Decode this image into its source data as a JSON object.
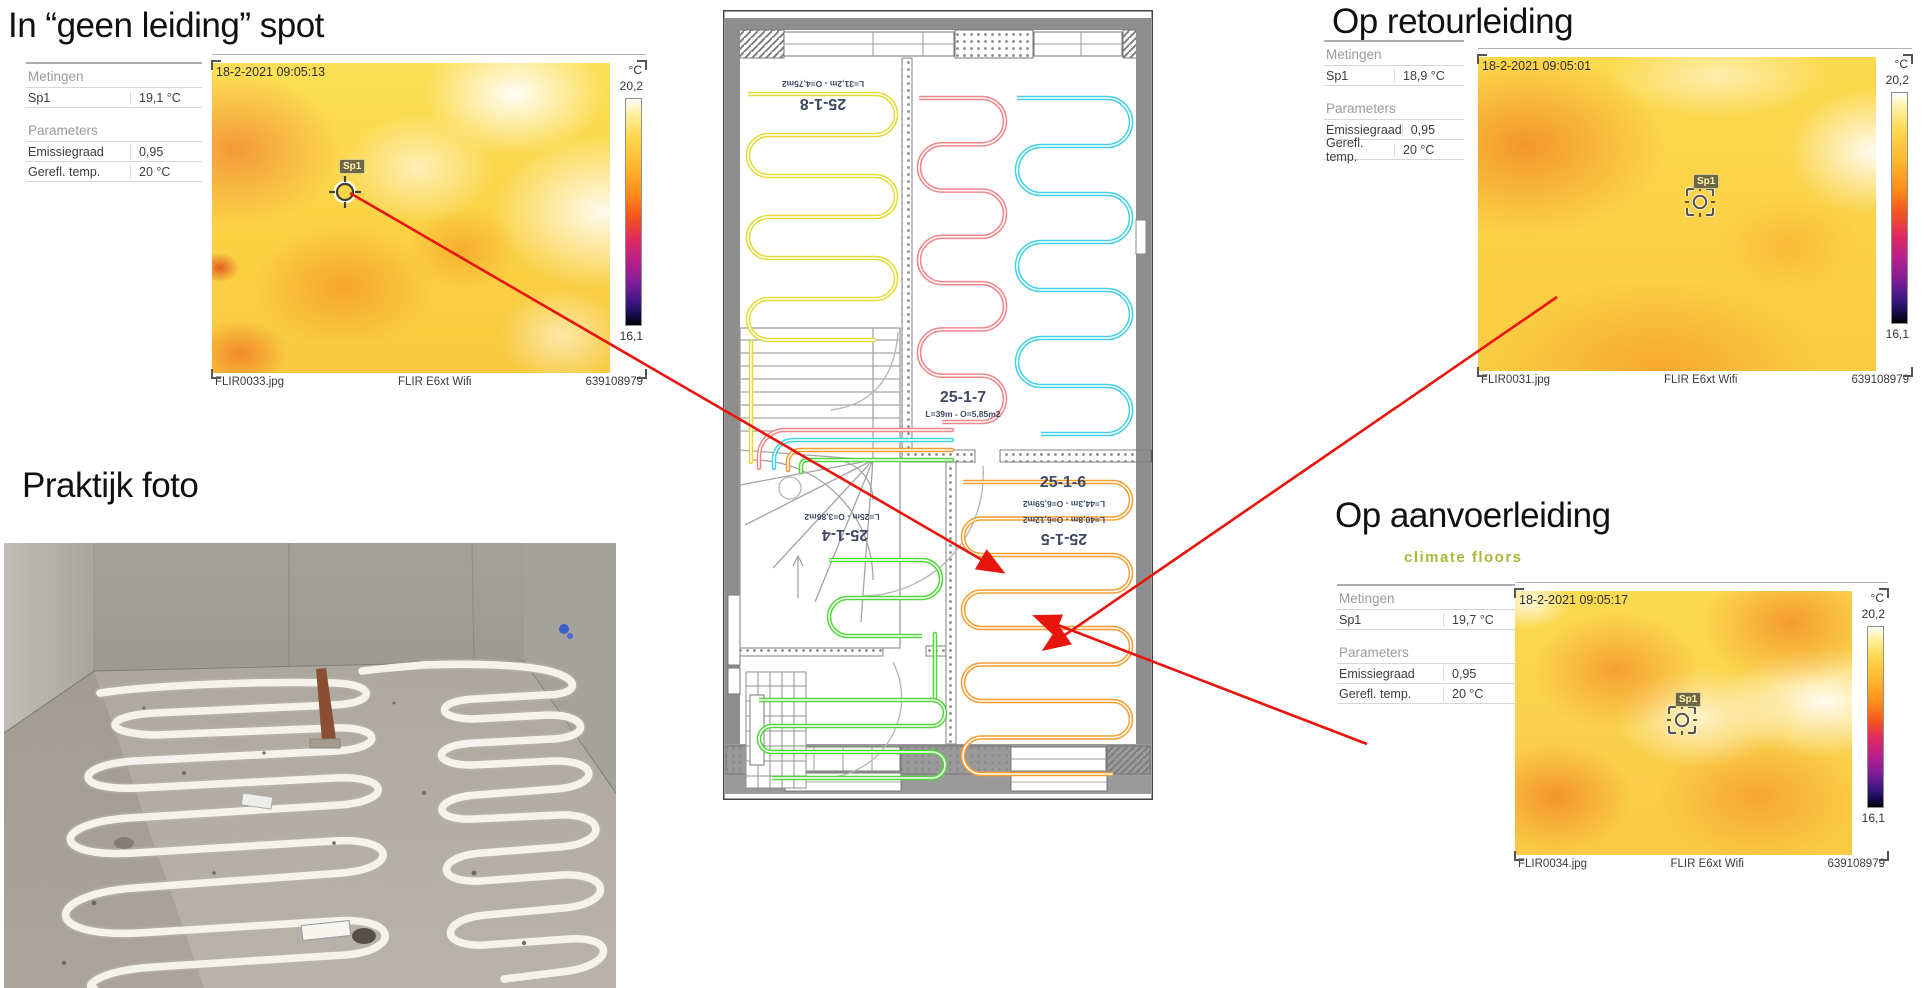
{
  "sections": {
    "geen_leiding": {
      "title": "In “geen leiding” spot"
    },
    "praktijk": {
      "title": "Praktijk foto"
    },
    "retour": {
      "title": "Op retourleiding"
    },
    "aanvoer": {
      "title": "Op aanvoerleiding",
      "logo": "climate floors"
    }
  },
  "meta_labels": {
    "measurements": "Metingen",
    "sp1": "Sp1",
    "parameters": "Parameters",
    "emissivity": "Emissiegraad",
    "refl_temp": "Gerefl. temp."
  },
  "panels": {
    "flir33": {
      "timestamp": "18-2-2021 09:05:13",
      "sp1_temp": "19,1 °C",
      "emissivity": "0,95",
      "refl_temp": "20 °C",
      "spot_label": "Sp1",
      "scale_unit": "°C",
      "scale_max": "20,2",
      "scale_min": "16,1",
      "file": "FLIR0033.jpg",
      "camera": "FLIR E6xt Wifi",
      "serial": "639108979"
    },
    "flir31": {
      "timestamp": "18-2-2021 09:05:01",
      "sp1_temp": "18,9 °C",
      "emissivity": "0,95",
      "refl_temp": "20 °C",
      "spot_label": "Sp1",
      "scale_unit": "°C",
      "scale_max": "20,2",
      "scale_min": "16,1",
      "file": "FLIR0031.jpg",
      "camera": "FLIR E6xt Wifi",
      "serial": "639108979"
    },
    "flir34": {
      "timestamp": "18-2-2021 09:05:17",
      "sp1_temp": "19,7 °C",
      "emissivity": "0,95",
      "refl_temp": "20 °C",
      "spot_label": "Sp1",
      "scale_unit": "°C",
      "scale_max": "20,2",
      "scale_min": "16,1",
      "file": "FLIR0034.jpg",
      "camera": "FLIR E6xt Wifi",
      "serial": "639108979"
    }
  },
  "floor_plan": {
    "loops": [
      {
        "id": "25-1-8",
        "label": "25-1-8",
        "dims": "L=31,2m - O=4,75m2",
        "color": "#e6da35",
        "x": 25,
        "y": 84,
        "w": 148,
        "h": 246,
        "runs": 7,
        "lx": 100,
        "ly": 89,
        "rot": 1,
        "dx": 100,
        "dy": 71,
        "drot": 1
      },
      {
        "id": "25-1-7",
        "label": "25-1-7",
        "dims": "L=39m - O=5.85m2",
        "color": "#f2858a",
        "x": 196,
        "y": 88,
        "w": 86,
        "h": 324,
        "runs": 8,
        "lx": 240,
        "ly": 392,
        "rot": 0,
        "dx": 240,
        "dy": 407,
        "drot": 0
      },
      {
        "id": "25-1-6",
        "label": "25-1-6",
        "dims": "L=44,3m - O=6,59m2",
        "color": "#3fd2e6",
        "x": 294,
        "y": 88,
        "w": 114,
        "h": 336,
        "runs": 8,
        "lx": 340,
        "ly": 477,
        "rot": 0,
        "dx": 341,
        "dy": 491,
        "drot": 1
      },
      {
        "id": "25-1-5",
        "label": "25-1-5",
        "dims": "L=40,8m - O=6,12m2",
        "color": "#f59d2e",
        "x": 240,
        "y": 472,
        "w": 168,
        "h": 292,
        "runs": 9,
        "lx": 341,
        "ly": 524,
        "rot": 1,
        "dx": 341,
        "dy": 507,
        "drot": 1
      },
      {
        "id": "25-1-4",
        "label": "25-1-4",
        "dims": "L=25m - O=3,86m2",
        "color": "#4fd83a",
        "x": 36,
        "y": 690,
        "w": 186,
        "h": 78,
        "runs": 4,
        "lx": 122,
        "ly": 520,
        "rot": 1,
        "dx": 119,
        "dy": 504,
        "drot": 1
      },
      {
        "id": "25-1-4b",
        "label": "",
        "dims": "",
        "color": "#4fd83a",
        "x": 106,
        "y": 550,
        "w": 112,
        "h": 76,
        "runs": 3,
        "lx": 0,
        "ly": 0,
        "rot": 0,
        "dx": 0,
        "dy": 0,
        "drot": 0
      }
    ]
  },
  "arrows": [
    {
      "x1": 350,
      "y1": 193,
      "x2": 1001,
      "y2": 571
    },
    {
      "x1": 1557,
      "y1": 297,
      "x2": 1046,
      "y2": 648
    },
    {
      "x1": 1367,
      "y1": 744,
      "x2": 1037,
      "y2": 617
    }
  ],
  "colors": {
    "arrow": "#e8150d",
    "logo": "#a9b83b",
    "plan_label": "#3e4a63"
  }
}
